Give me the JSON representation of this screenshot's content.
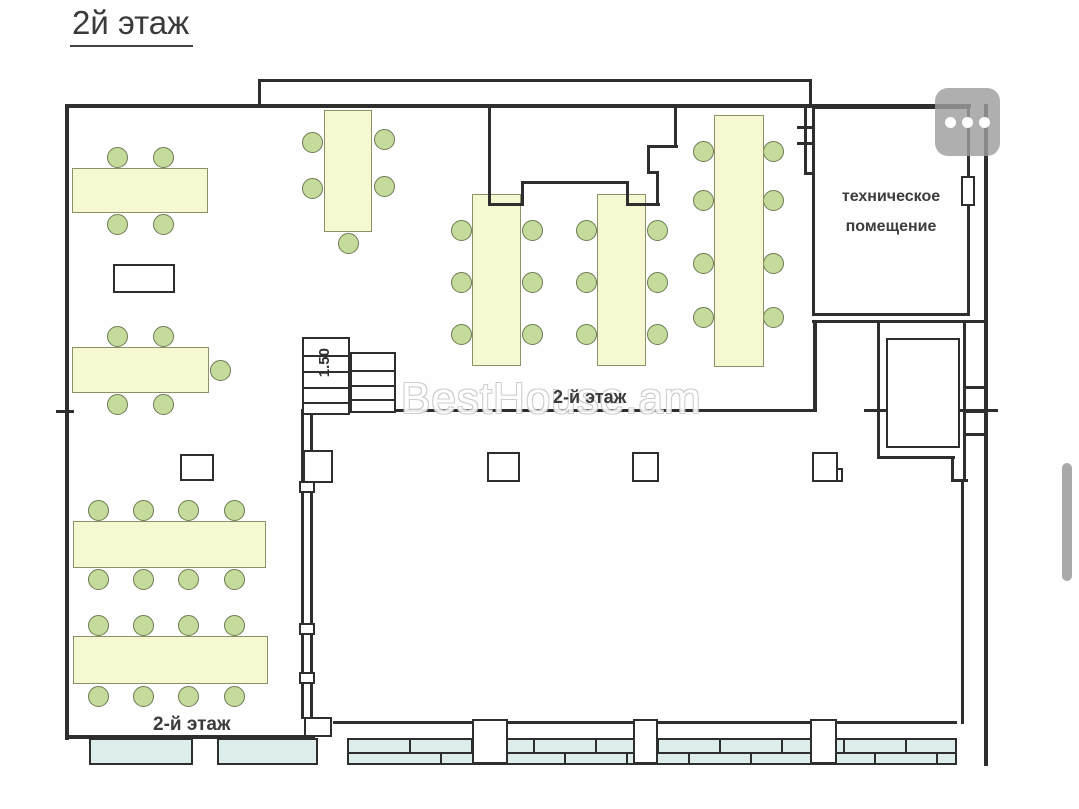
{
  "page": {
    "title": "2й этаж"
  },
  "floor_plan": {
    "labels": {
      "center_floor": "2-й этаж",
      "bottom_floor": "2-й этаж",
      "tech_room_line1": "техническое",
      "tech_room_line2": "помещение",
      "stairs_height": "1.50",
      "watermark": "BestHouse.am"
    },
    "colors": {
      "wall": "#2e2e2e",
      "tablefill": "#f6f8d2",
      "tableborder": "#8d9168",
      "chairfill": "#c4db9c",
      "chairborder": "#6e7a52",
      "winfill": "#ddedec",
      "scroll": "#a9a9a9"
    },
    "counts": {
      "tables": 8,
      "chairs": 50
    },
    "walls": [
      [
        65,
        104,
        906,
        4
      ],
      [
        258,
        79,
        554,
        3
      ],
      [
        258,
        79,
        3,
        28
      ],
      [
        809,
        79,
        3,
        28
      ],
      [
        65,
        104,
        4,
        636
      ],
      [
        56,
        410,
        18,
        3
      ],
      [
        65,
        735,
        250,
        4
      ],
      [
        984,
        104,
        4,
        662
      ],
      [
        333,
        721,
        624,
        3
      ],
      [
        488,
        104,
        3,
        102
      ],
      [
        488,
        203,
        35,
        3
      ],
      [
        521,
        181,
        3,
        25
      ],
      [
        521,
        181,
        107,
        3
      ],
      [
        626,
        181,
        3,
        25
      ],
      [
        626,
        203,
        34,
        3
      ],
      [
        656,
        171,
        3,
        35
      ],
      [
        647,
        171,
        12,
        3
      ],
      [
        647,
        145,
        3,
        29
      ],
      [
        647,
        145,
        31,
        3
      ],
      [
        674,
        104,
        3,
        44
      ],
      [
        393,
        409,
        422,
        3
      ],
      [
        864,
        409,
        30,
        3
      ],
      [
        948,
        409,
        50,
        3
      ],
      [
        804,
        104,
        3,
        70
      ],
      [
        797,
        126,
        18,
        3
      ],
      [
        797,
        142,
        18,
        3
      ],
      [
        804,
        172,
        10,
        3
      ],
      [
        812,
        320,
        174,
        3
      ],
      [
        813,
        322,
        4,
        90
      ],
      [
        877,
        322,
        3,
        137
      ],
      [
        877,
        456,
        78,
        3
      ],
      [
        951,
        456,
        3,
        26
      ],
      [
        951,
        479,
        17,
        3
      ],
      [
        963,
        322,
        3,
        160
      ],
      [
        963,
        386,
        23,
        3
      ],
      [
        963,
        410,
        23,
        3
      ],
      [
        963,
        433,
        23,
        3
      ],
      [
        961,
        481,
        3,
        243
      ]
    ],
    "double_wall": {
      "x": 301,
      "y": 409,
      "w": 12,
      "h": 310
    },
    "tables": [
      [
        72,
        168,
        136,
        45
      ],
      [
        324,
        110,
        48,
        122
      ],
      [
        72,
        347,
        137,
        46
      ],
      [
        73,
        521,
        193,
        47
      ],
      [
        73,
        636,
        195,
        48
      ],
      [
        472,
        194,
        49,
        172
      ],
      [
        597,
        194,
        49,
        172
      ],
      [
        714,
        115,
        50,
        252
      ]
    ],
    "chairs": [
      [
        117,
        157
      ],
      [
        163,
        157
      ],
      [
        117,
        224
      ],
      [
        163,
        224
      ],
      [
        312,
        142
      ],
      [
        312,
        188
      ],
      [
        384,
        139
      ],
      [
        384,
        186
      ],
      [
        348,
        243
      ],
      [
        117,
        336
      ],
      [
        163,
        336
      ],
      [
        220,
        370
      ],
      [
        117,
        404
      ],
      [
        163,
        404
      ],
      [
        98,
        510
      ],
      [
        143,
        510
      ],
      [
        188,
        510
      ],
      [
        234,
        510
      ],
      [
        98,
        579
      ],
      [
        143,
        579
      ],
      [
        188,
        579
      ],
      [
        234,
        579
      ],
      [
        98,
        625
      ],
      [
        143,
        625
      ],
      [
        188,
        625
      ],
      [
        234,
        625
      ],
      [
        98,
        696
      ],
      [
        143,
        696
      ],
      [
        188,
        696
      ],
      [
        234,
        696
      ],
      [
        461,
        230
      ],
      [
        461,
        282
      ],
      [
        461,
        334
      ],
      [
        532,
        230
      ],
      [
        532,
        282
      ],
      [
        532,
        334
      ],
      [
        586,
        230
      ],
      [
        586,
        282
      ],
      [
        586,
        334
      ],
      [
        657,
        230
      ],
      [
        657,
        282
      ],
      [
        657,
        334
      ],
      [
        703,
        151
      ],
      [
        703,
        200
      ],
      [
        703,
        263
      ],
      [
        703,
        317
      ],
      [
        773,
        151
      ],
      [
        773,
        200
      ],
      [
        773,
        263
      ],
      [
        773,
        317
      ]
    ],
    "boxes": [
      [
        113,
        264,
        62,
        29
      ],
      [
        180,
        454,
        34,
        27
      ],
      [
        303,
        450,
        30,
        33
      ],
      [
        487,
        452,
        33,
        30
      ],
      [
        632,
        452,
        27,
        30
      ],
      [
        812,
        452,
        26,
        30
      ],
      [
        836,
        468,
        7,
        14
      ],
      [
        961,
        176,
        14,
        30
      ],
      [
        299,
        481,
        16,
        12
      ],
      [
        299,
        623,
        16,
        12
      ],
      [
        299,
        672,
        16,
        12
      ],
      [
        304,
        717,
        28,
        20
      ],
      [
        886,
        338,
        74,
        110
      ]
    ],
    "tech_room": {
      "x": 812,
      "y": 106,
      "w": 158,
      "h": 210
    },
    "windows_plain": [
      [
        89,
        738,
        104,
        27
      ],
      [
        217,
        738,
        101,
        27
      ]
    ],
    "window_strip": {
      "x": 347,
      "y": 738,
      "w": 610,
      "h": 27
    },
    "pillars": [
      [
        472,
        719,
        36,
        45
      ],
      [
        633,
        719,
        25,
        45
      ],
      [
        810,
        719,
        27,
        45
      ]
    ],
    "stairs": {
      "flights": [
        {
          "x": 302,
          "y": 337,
          "w": 48,
          "h": 78,
          "treads": [
            16,
            32,
            48,
            63
          ]
        },
        {
          "x": 350,
          "y": 352,
          "w": 46,
          "h": 61,
          "treads": [
            16,
            31,
            45
          ]
        }
      ]
    }
  },
  "controls": {
    "menu_button": {
      "icon": "ellipsis-icon",
      "dots": 3
    },
    "scrollbar": {
      "visible": true
    }
  }
}
